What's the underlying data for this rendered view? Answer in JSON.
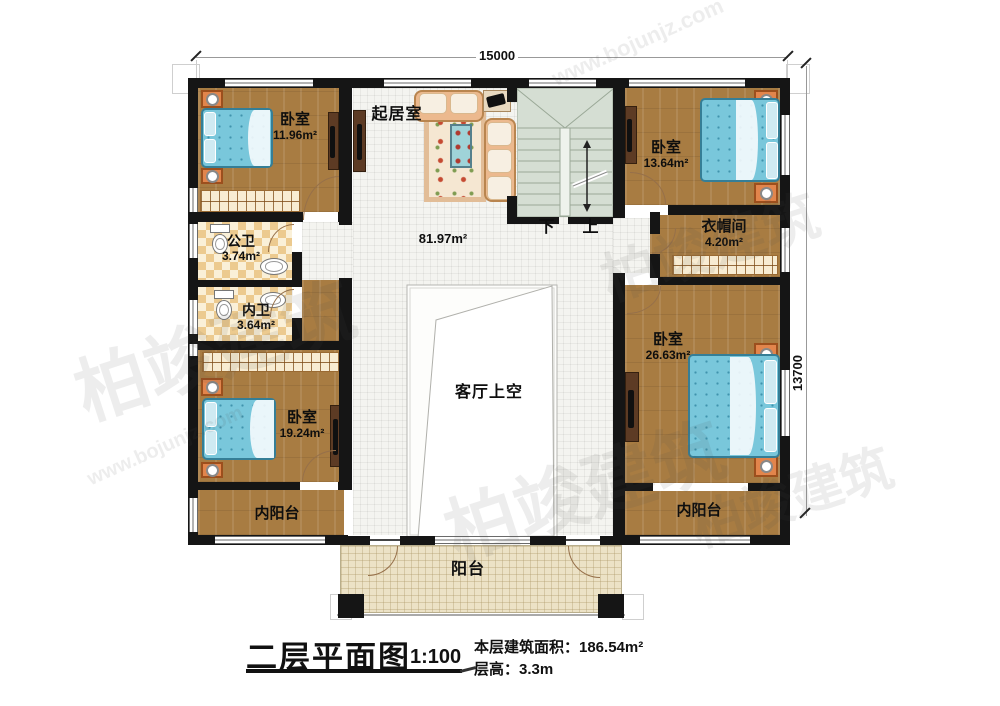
{
  "dimensions": {
    "width_label": "15000",
    "height_label": "13700"
  },
  "rooms": {
    "bedroom_top_left": {
      "name": "卧室",
      "area": "11.96m²"
    },
    "living_room": {
      "name": "起居室"
    },
    "hall": {
      "area": "81.97m²"
    },
    "bedroom_top_right": {
      "name": "卧室",
      "area": "13.64m²"
    },
    "cloakroom": {
      "name": "衣帽间",
      "area": "4.20m²"
    },
    "public_bathroom": {
      "name": "公卫",
      "area": "3.74m²"
    },
    "inner_bathroom": {
      "name": "内卫",
      "area": "3.64m²"
    },
    "bedroom_bottom_left": {
      "name": "卧室",
      "area": "19.24m²"
    },
    "bedroom_bottom_right": {
      "name": "卧室",
      "area": "26.63m²"
    },
    "void_over_living": {
      "name": "客厅上空"
    },
    "inner_balcony_left": {
      "name": "内阳台"
    },
    "inner_balcony_right": {
      "name": "内阳台"
    },
    "balcony": {
      "name": "阳台"
    }
  },
  "stairs": {
    "down_label": "下",
    "up_label": "上"
  },
  "title_block": {
    "title": "二层平面图",
    "scale": "1:100",
    "floor_area": "本层建筑面积：186.54m²",
    "floor_height": "层高：3.3m"
  },
  "watermark": {
    "brand": "柏竣建筑",
    "url": "www.bojunjz.com"
  },
  "colors": {
    "wall": "#151515",
    "wood": "#a87c42",
    "bed": "#79c7db",
    "stair": "#d5ded3",
    "balcony": "#ece2c6"
  }
}
